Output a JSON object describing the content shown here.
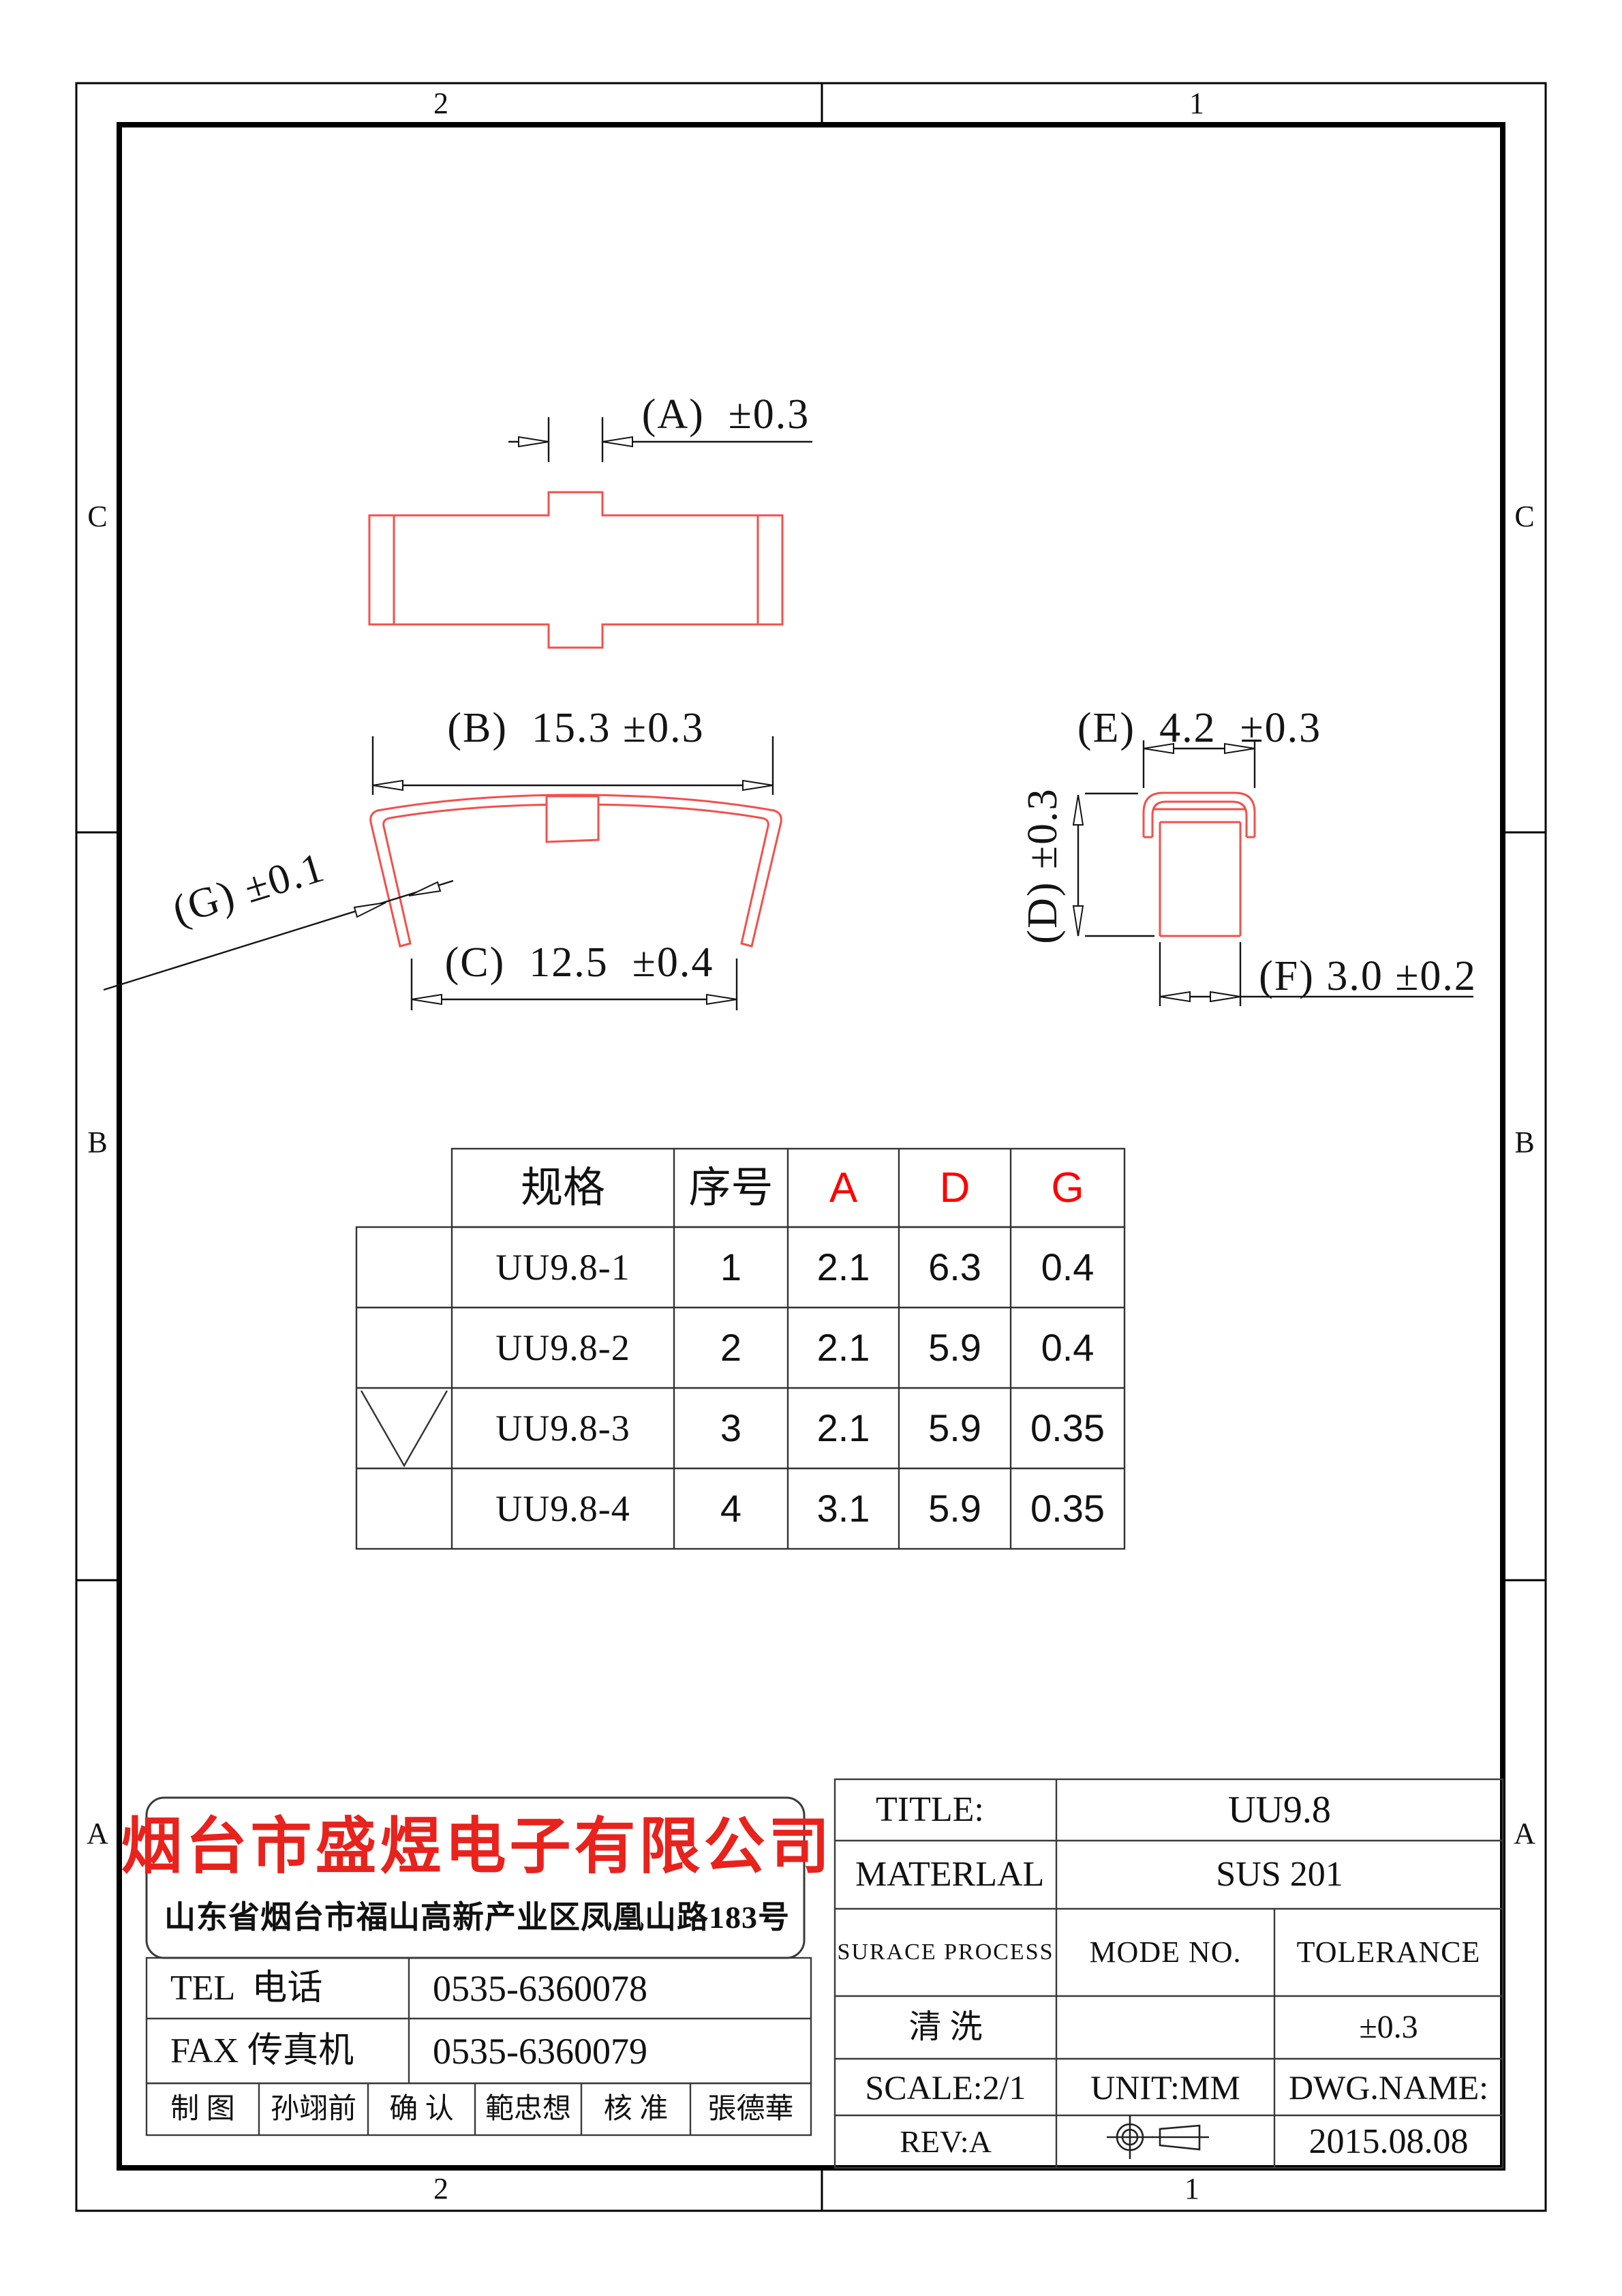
{
  "colors": {
    "drawing_red": "#f2504b",
    "table_header_red": "#ff0000",
    "company_red": "#e8221c",
    "line_black": "#141414"
  },
  "zones": {
    "top": [
      "2",
      "1"
    ],
    "bottom": [
      "2",
      "1"
    ],
    "left": [
      "C",
      "B",
      "A"
    ],
    "right": [
      "C",
      "B",
      "A"
    ]
  },
  "dimensions": {
    "a": "(A)  ±0.3",
    "b": "(B)  15.3 ±0.3",
    "c": "(C)  12.5  ±0.4",
    "g": "(G) ±0.1",
    "e": "(E)  4.2  ±0.3",
    "d": "(D) ±0.3",
    "f": "(F) 3.0 ±0.2"
  },
  "spec_table": {
    "headers": {
      "spec": "规格",
      "no": "序号",
      "a": "A",
      "d": "D",
      "g": "G"
    },
    "rows": [
      {
        "spec": "UU9.8-1",
        "no": "1",
        "a": "2.1",
        "d": "6.3",
        "g": "0.4"
      },
      {
        "spec": "UU9.8-2",
        "no": "2",
        "a": "2.1",
        "d": "5.9",
        "g": "0.4"
      },
      {
        "spec": "UU9.8-3",
        "no": "3",
        "a": "2.1",
        "d": "5.9",
        "g": "0.35"
      },
      {
        "spec": "UU9.8-4",
        "no": "4",
        "a": "3.1",
        "d": "5.9",
        "g": "0.35"
      }
    ],
    "checked_row": "UU9.8-3"
  },
  "title_block": {
    "company": {
      "name": "烟台市盛煜电子有限公司",
      "address": "山东省烟台市福山高新产业区凤凰山路183号",
      "tel_label": "TEL  电话",
      "tel_value": "0535-6360078",
      "fax_label": "FAX 传真机",
      "fax_value": "0535-6360079",
      "roles": [
        {
          "label": "制 图",
          "value": "孙翊前"
        },
        {
          "label": "确 认",
          "value": "範忠想"
        },
        {
          "label": "核 准",
          "value": "張德華"
        }
      ]
    },
    "info": {
      "title_label": "TITLE:",
      "title_value": "UU9.8",
      "material_label": "MATERLAL",
      "material_value": "SUS 201",
      "surface_label": "SURACE PROCESS",
      "mode_label": "MODE NO.",
      "tolerance_label": "TOLERANCE",
      "surface_value": "清 洗",
      "tolerance_value": "±0.3",
      "scale": "SCALE:2/1",
      "unit": "UNIT:MM",
      "dwg_name": "DWG.NAME:",
      "rev": "REV:A",
      "date": "2015.08.08"
    }
  }
}
